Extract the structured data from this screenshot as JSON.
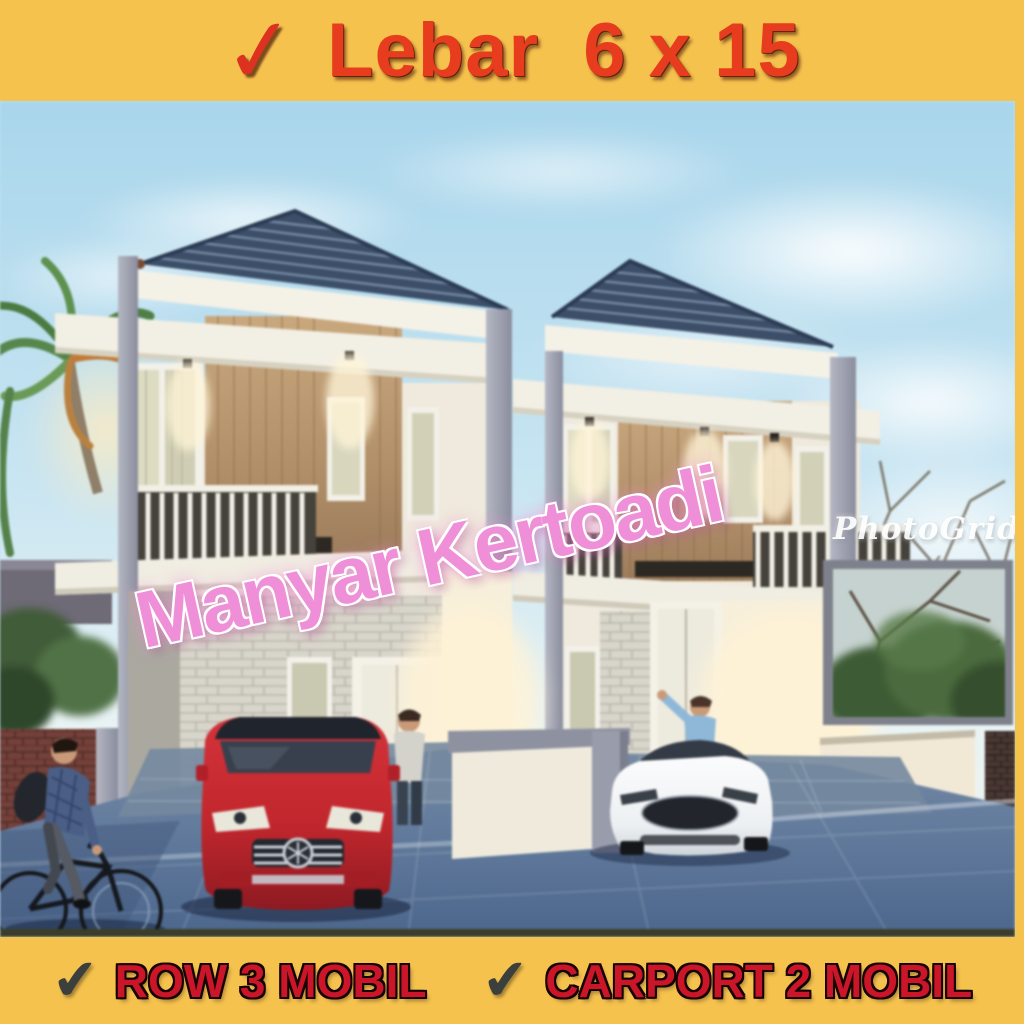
{
  "meta": {
    "description": "Real-estate promotional square image: dusk 3D rendering of twin two-storey houses inside a yellow frame with red sales captions"
  },
  "top_banner": {
    "checkmark": "✓",
    "text": "Lebar  6 x 15"
  },
  "bottom_banner": {
    "items": [
      {
        "checkmark": "✔",
        "text": "ROW 3 MOBIL"
      },
      {
        "checkmark": "✔",
        "text": "CARPORT 2 MOBIL"
      }
    ]
  },
  "photo": {
    "watermark_diagonal": "Manyar Kertoadi",
    "watermark_logo": "PhotoGrid",
    "scene_description": "Two identical two-storey minimalist townhouses with dark blue hip roofs, cream walls, timber feature panels and white balcony railings; a red SUV parked in the left carport and a white sedan in the right carport; a man stands at each front door; a cyclist rides past a red-brick wall at lower left; palm tree at left, bare trees, framed greenery and a brick pier at right; wide blue-grey paved frontage."
  },
  "palette": {
    "frame_yellow": "#F6C24E",
    "top_text_red": "#E73D1E",
    "bottom_text_red": "#CB1528",
    "check_dark": "#3B403C",
    "watermark_pink": "#EF8FD8",
    "logo_white": "#FDFDFD",
    "sky_blue": "#BFE1F0",
    "roof_slate_blue": "#3C4E68",
    "wall_cream": "#F0EBDF",
    "timber_tan": "#C7A67E",
    "paving_blue_grey": "#60799B",
    "suv_red": "#C1272D",
    "sedan_white": "#F4F5F6"
  }
}
